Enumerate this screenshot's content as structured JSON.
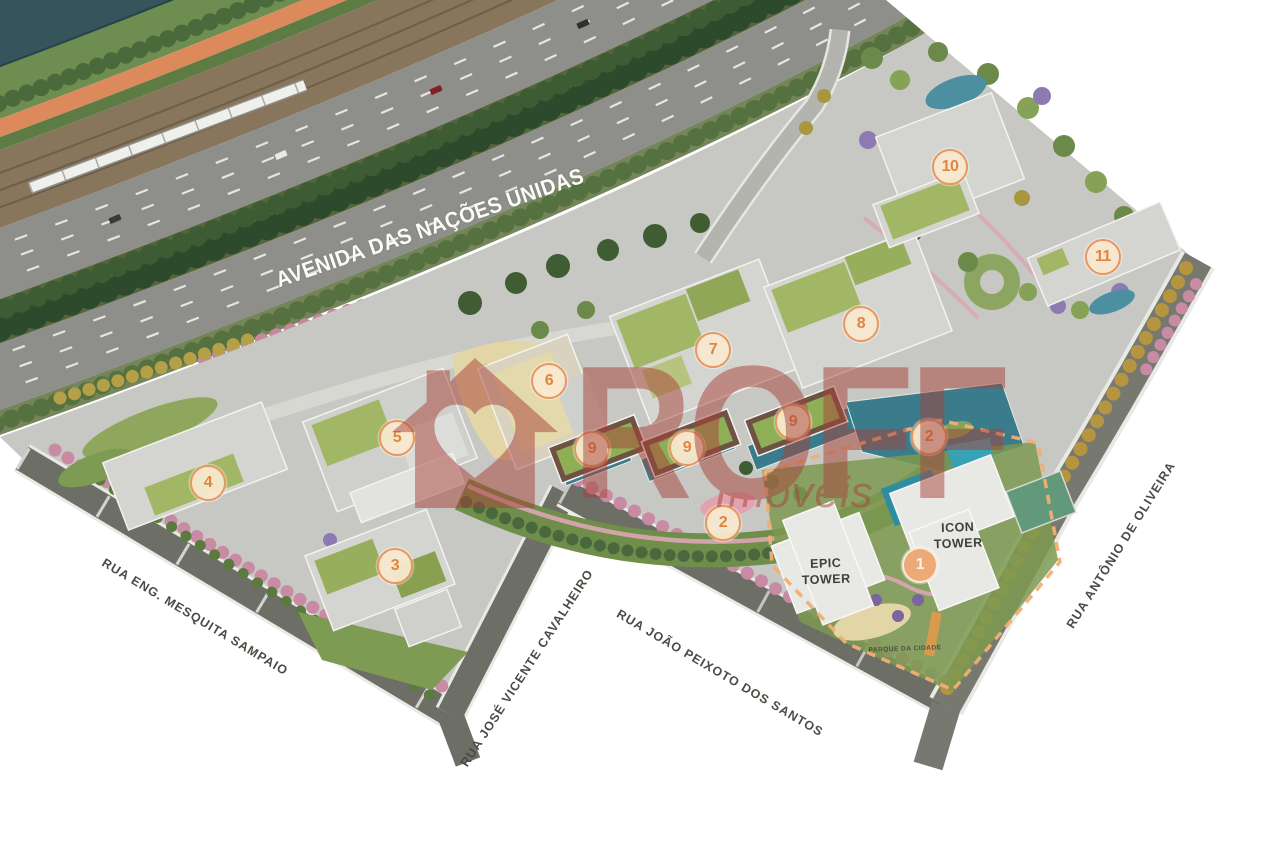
{
  "map": {
    "avenue_label": "AVENIDA DAS NAÇÕES UNIDAS",
    "streets": [
      {
        "name": "RUA ENG. MESQUITA SAMPAIO"
      },
      {
        "name": "RUA JOSÉ VICENTE CAVALHEIRO"
      },
      {
        "name": "RUA JOÃO PEIXOTO DOS SANTOS"
      },
      {
        "name": "RUA ANTÔNIO DE OLIVEIRA"
      }
    ],
    "towers": [
      {
        "name": "EPIC TOWER"
      },
      {
        "name": "ICON TOWER"
      }
    ],
    "ground_sign": "PARQUE DA CIDADE",
    "markers": [
      {
        "num": "1",
        "x": 920,
        "y": 565,
        "variant": "highlight"
      },
      {
        "num": "2",
        "x": 929,
        "y": 437,
        "variant": "default"
      },
      {
        "num": "2",
        "x": 723,
        "y": 523,
        "variant": "default"
      },
      {
        "num": "3",
        "x": 395,
        "y": 566,
        "variant": "default"
      },
      {
        "num": "4",
        "x": 208,
        "y": 483,
        "variant": "default"
      },
      {
        "num": "5",
        "x": 397,
        "y": 438,
        "variant": "default"
      },
      {
        "num": "6",
        "x": 549,
        "y": 381,
        "variant": "default"
      },
      {
        "num": "7",
        "x": 713,
        "y": 350,
        "variant": "default"
      },
      {
        "num": "8",
        "x": 861,
        "y": 324,
        "variant": "default"
      },
      {
        "num": "9",
        "x": 592,
        "y": 449,
        "variant": "default"
      },
      {
        "num": "9",
        "x": 687,
        "y": 448,
        "variant": "default"
      },
      {
        "num": "9",
        "x": 793,
        "y": 422,
        "variant": "default"
      },
      {
        "num": "10",
        "x": 950,
        "y": 167,
        "variant": "default"
      },
      {
        "num": "11",
        "x": 1103,
        "y": 257,
        "variant": "default"
      }
    ],
    "colors": {
      "water": "#35545c",
      "bike_path": "#dc8a5b",
      "road": "#8e8f8a",
      "site": "#c7c8c3",
      "roof_green": "#a2b765",
      "pool": "#3a7c8c",
      "marker_ring": "#e9975f",
      "marker_fill": "#f7e8d0",
      "marker_highlight": "#edaa78",
      "boundary_dash": "#f2ae74",
      "watermark": "#a8423a"
    }
  },
  "watermark": {
    "brand": "ROFF",
    "tagline": "Imóveis"
  }
}
